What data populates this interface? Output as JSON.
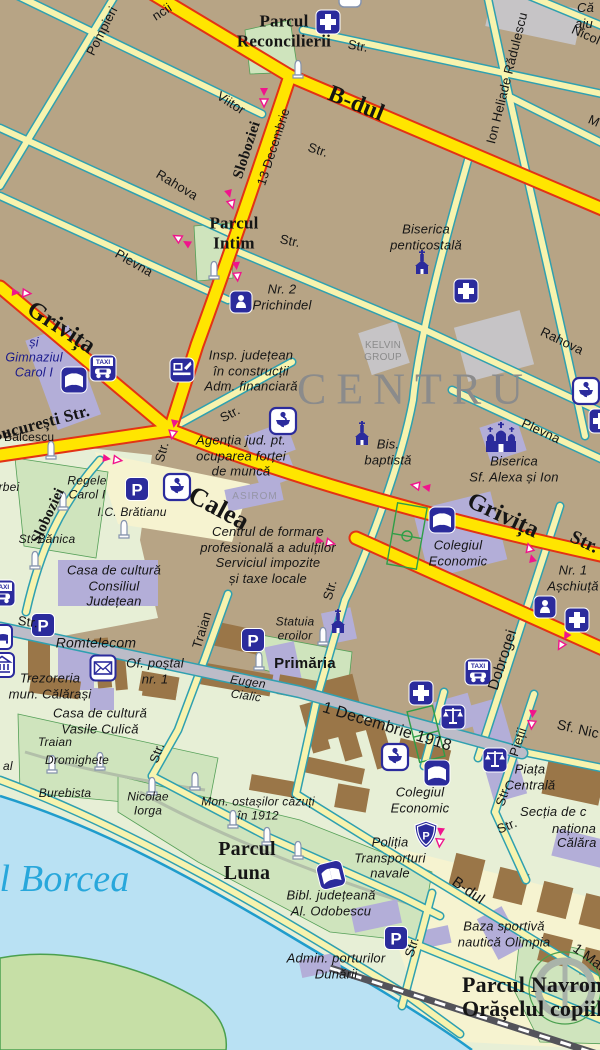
{
  "colors": {
    "block_tan": "#b7a485",
    "road_major": "#ffe500",
    "road_major_casing": "#e23315",
    "road_minor": "#f7f3ae",
    "road_casing": "#2fa0b0",
    "road_gray": "#bcbcc8",
    "park_green": "#cfe4bd",
    "water_blue": "#b9e1f3",
    "icon_blue": "#2b2b9c",
    "arrow_pink": "#f0148c",
    "district_gray": "#8b8b8b",
    "river_label_blue": "#28a7db",
    "public_building": "#b3aed8",
    "building_brown": "#9a7648"
  },
  "district": {
    "centru": "CENTRU"
  },
  "river": {
    "name": "Brațul Borcea"
  },
  "parks": {
    "reconcilierii": [
      "Parcul",
      "Reconcilierii"
    ],
    "intim": [
      "Parcul",
      "Intim"
    ],
    "luna": [
      "Parcul",
      "Luna"
    ],
    "navrom": [
      "Parcul Navrom",
      "Orășelul copiilor"
    ]
  },
  "streets": {
    "bdul": "B-dul",
    "bdul_s": "B-dul",
    "pompieri": "Pompieri",
    "viitor": "Viitor",
    "rahova_w": "Rahova",
    "rahova_e": "Rahova",
    "plevna_w": "Plevna",
    "plevna_e": "Plevna",
    "sloboziei_n": "Sloboziei",
    "sloboziei_s": "Sloboziei",
    "dec13": "13 Decembrie",
    "ihr": "Ion Heliade Rădulescu",
    "grivita_nw": "Grivița",
    "calea": "Calea",
    "grivita_e": "Grivița",
    "grivita_e_str": "Str.",
    "bucuresti": "București Str.",
    "traian": "Traian",
    "dobrogei": "Dobrogei",
    "pietii": "Pieții",
    "pietii_str": "Str.",
    "sf_nicolae": "Sf. Nic",
    "dec1918": "1 Decembrie 1918",
    "eugen_cialic": [
      "Eugen",
      "Cialic"
    ],
    "unu_mai": "1 Mai",
    "str": "Str.",
    "frag_ncii": "ncii",
    "frag_nicolae": "Nicol",
    "frag_m": "M"
  },
  "pois": {
    "biserica_penticostala": [
      "Biserica",
      "penticostală"
    ],
    "prichindel": [
      "Nr. 2",
      "Prichindel"
    ],
    "gimnaziul": [
      "și",
      "Gimnaziul",
      "Carol I"
    ],
    "insp": [
      "Insp. județean",
      "în construcții",
      "Adm. financiară"
    ],
    "agentia": [
      "Agenția jud. pt.",
      "ocuparea forței",
      "de muncă"
    ],
    "balcescu": "Bălcescu",
    "regele": [
      "Regele",
      "Carol I"
    ],
    "bratianu": "I.C. Brătianu",
    "banica": "St. Bănica",
    "centrul": [
      "Centrul de formare",
      "profesională a adulților",
      "Serviciul impozite",
      "și taxe locale"
    ],
    "casa_cj": [
      "Casa de cultură",
      "Consiliul",
      "Județean"
    ],
    "bis_baptista": [
      "Bis.",
      "baptistă"
    ],
    "alexa": [
      "Biserica",
      "Sf. Alexa și Ion"
    ],
    "colegiul_n": [
      "Colegiul",
      "Economic"
    ],
    "aschiuta": [
      "Nr. 1",
      "Așchiuță"
    ],
    "statuia": [
      "Statuia",
      "eroilor"
    ],
    "primaria": "Primăria",
    "romtelecom": "Romtelecom",
    "postal": [
      "Of. poștal",
      "nr. 1"
    ],
    "trezoreria": [
      "Trezoreria",
      "mun. Călărași"
    ],
    "culica": [
      "Casa de cultură",
      "Vasile Culică"
    ],
    "mon_traian": "Traian",
    "dromighete": "Dromighete",
    "burebista": "Burebista",
    "iorga": [
      "Nicolae",
      "Iorga"
    ],
    "mon1912": [
      "Mon. ostașilor căzuți",
      "în 1912"
    ],
    "bibl": [
      "Bibl. județeană",
      "Al. Odobescu"
    ],
    "politia": [
      "Poliția",
      "Transporturi",
      "navale"
    ],
    "colegiul_s": [
      "Colegiul",
      "Economic"
    ],
    "piata": [
      "Piața",
      "Centrală"
    ],
    "baza": [
      "Baza sportivă",
      "nautică Olimpia"
    ],
    "admin": [
      "Admin. porturilor",
      "Dunării"
    ]
  },
  "companies": {
    "kelvin": [
      "KELVIN",
      "GROUP"
    ],
    "asirom": "ASIROM"
  },
  "fragments": {
    "casa": "Că",
    "ajutor": "aju",
    "stirbei": "Știrbei",
    "al": "al",
    "sectia_1": "Secția de c",
    "sectia_2": "naționa",
    "sectia_3": "Călăra"
  },
  "icons": {
    "parking_glyph": "P",
    "taxi_glyph": "TAXI",
    "police_glyph": "P",
    "legend": {
      "hospital": "blue-square-white-cross",
      "pharmacy": "white-square-bowl-of-hygieia",
      "parking": "blue-square-P",
      "taxi": "blue-square-TAXI-car",
      "school_library": "blue-square-open-book",
      "kindergarten": "blue-square-baby",
      "justice": "blue-square-scales",
      "church": "blue-church-silhouette",
      "monument": "white-obelisk",
      "post_office": "white-square-envelope",
      "police": "blue-shield-P",
      "administration": "blue-square-computer",
      "hotel": "white-square-bed",
      "one_way": "pink-arrow-pair"
    }
  }
}
